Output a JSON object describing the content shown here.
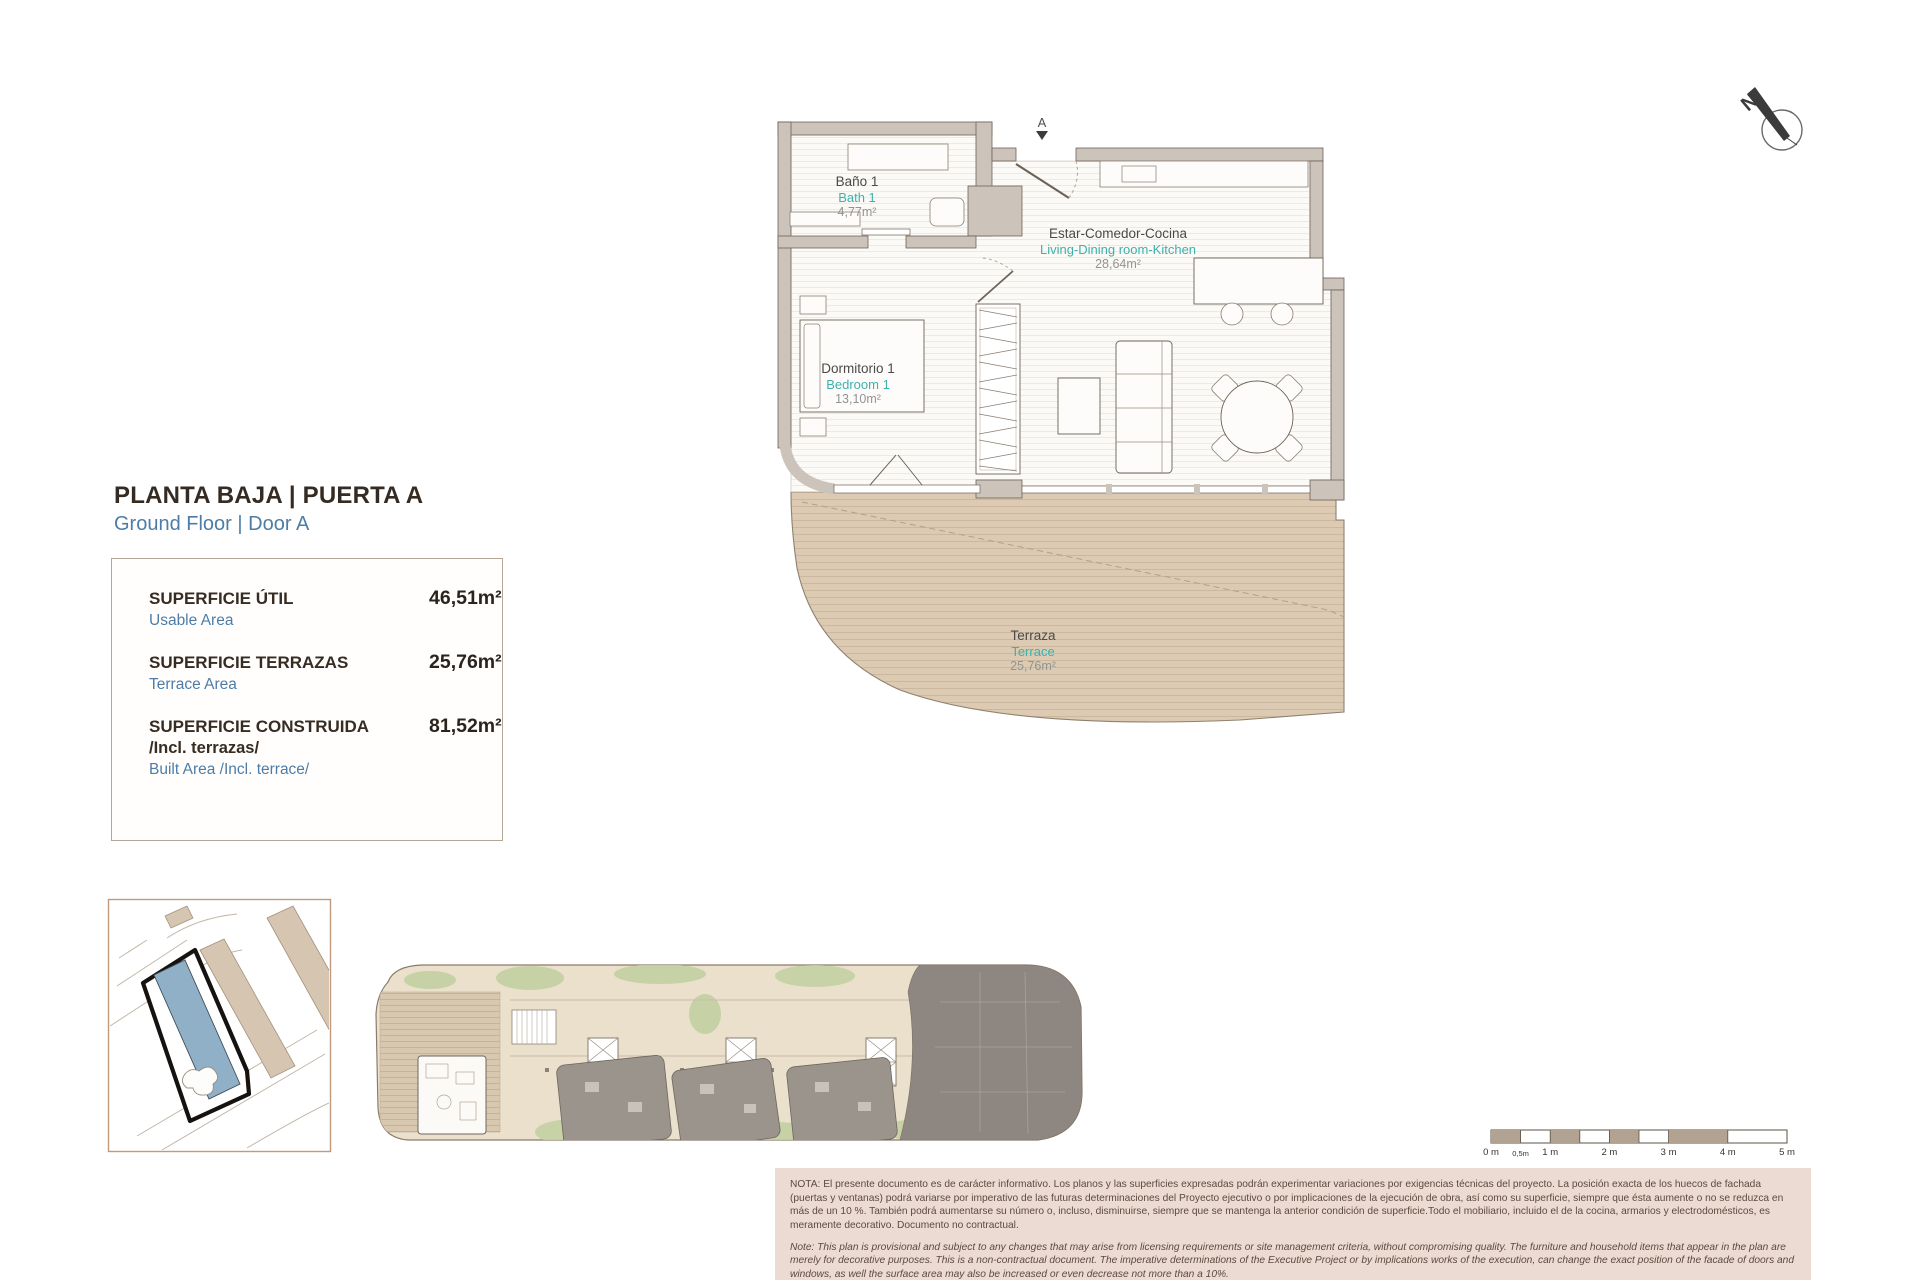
{
  "header": {
    "title_es": "PLANTA BAJA | PUERTA A",
    "title_en": "Ground Floor | Door A"
  },
  "area_table": {
    "rows": [
      {
        "label_es": "SUPERFICIE ÚTIL",
        "label_es_extra": "",
        "label_en": "Usable Area",
        "value": "46,51m²"
      },
      {
        "label_es": "SUPERFICIE TERRAZAS",
        "label_es_extra": "",
        "label_en": "Terrace Area",
        "value": "25,76m²"
      },
      {
        "label_es": "SUPERFICIE CONSTRUIDA",
        "label_es_extra": "/Incl. terrazas/",
        "label_en": "Built Area /Incl. terrace/",
        "value": "81,52m²"
      }
    ]
  },
  "floor_plan": {
    "entrance_label": "A",
    "rooms": {
      "bath": {
        "name_es": "Baño 1",
        "name_en": "Bath 1",
        "area": "4,77m²"
      },
      "living": {
        "name_es": "Estar-Comedor-Cocina",
        "name_en": "Living-Dining room-Kitchen",
        "area": "28,64m²"
      },
      "bedroom": {
        "name_es": "Dormitorio 1",
        "name_en": "Bedroom 1",
        "area": "13,10m²"
      },
      "terrace": {
        "name_es": "Terraza",
        "name_en": "Terrace",
        "area": "25,76m²"
      }
    }
  },
  "compass": {
    "label": "N"
  },
  "scale_bar": {
    "labels": [
      "0 m",
      "0,5m",
      "1 m",
      "2 m",
      "3 m",
      "4 m",
      "5 m"
    ]
  },
  "notes": {
    "es": "NOTA:  El presente documento es de carácter informativo. Los planos y las superficies expresadas podrán experimentar variaciones por exigencias técnicas del proyecto. La posición exacta de los huecos de fachada (puertas y ventanas) podrá variarse por imperativo de las futuras determinaciones del Proyecto ejecutivo o por implicaciones de la ejecución de obra, así como su superficie, siempre que ésta aumente o no se reduzca en más de un 10 %. También podrá aumentarse su número o, incluso, disminuirse, siempre que se mantenga la anterior condición de superficie.Todo el mobiliario, incluido el de la cocina, armarios y electrodomésticos, es meramente decorativo. Documento no contractual.",
    "en": "Note: This plan is provisional and subject to any changes that may arise from licensing requirements or site management criteria, without compromising quality. The furniture and household items that appear in the plan are merely for decorative purposes. This is a non-contractual document. The imperative determinations of the Executive Project or by implications works of the execution, can change the exact position of the facade of doors and windows, as well the surface area may also be increased or even decrease not more than a 10%.",
    "version": "V.1_JUN-25"
  },
  "colors": {
    "accent_blue": "#4d7da7",
    "accent_teal": "#3eb1ad",
    "wall_gray": "#ccc4bb",
    "terrace_tan": "#dccab2",
    "highlight_blue": "#8fb0c7",
    "note_background": "#ecdbd2"
  }
}
